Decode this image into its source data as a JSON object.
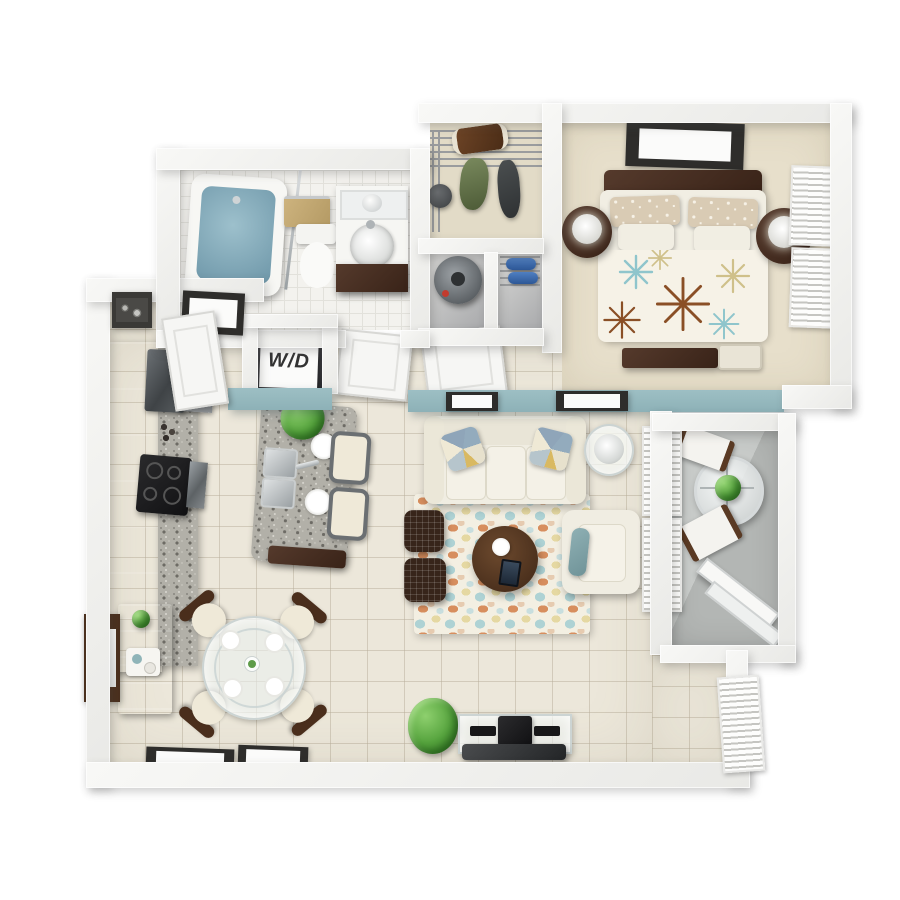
{
  "scene": {
    "description": "Top-down 3D render floor plan of a one-bedroom, one-bathroom apartment with balcony",
    "visible_text": [
      "W/D"
    ]
  },
  "labels": {
    "washer_dryer": "W/D"
  },
  "palette": {
    "background": "#ffffff",
    "wall": "#f1f1ef",
    "accent_wall_teal": "#9dbfc4",
    "tile_floor": "#ece7da",
    "bath_tile": "#f3f2ee",
    "carpet": "#e7dfcb",
    "balcony_concrete": "#b9bcba",
    "cabinet_espresso": "#46302a",
    "granite": "#b2b0a8",
    "appliance_black": "#1d1d1f",
    "stainless": "#9ea3a7",
    "sofa_cream": "#f1eee3",
    "rug_base": "#f3efe2",
    "rug_orange": "#d78e5e",
    "rug_teal": "#aed2d4",
    "rug_yellow": "#e5d8a2",
    "wood_dark": "#53382a",
    "ottoman_dark": "#37251a",
    "water_blue": "#7fa8b8",
    "plant_green": "#54a23c"
  },
  "rooms": {
    "bedroom": {
      "name": "Bedroom",
      "furniture": {
        "bed": "Queen bed with floral duvet",
        "headboard": "Dark wood headboard",
        "nightstand_left": "Round nightstand with lamp",
        "nightstand_right": "Round nightstand with lamp",
        "wall_art": "Framed wall art",
        "dresser": "Low dresser",
        "bench": "Bedside bench",
        "windows": "Windows with blinds"
      }
    },
    "closet": {
      "name": "Walk-in closet",
      "furniture": {
        "shelving": "Wire shelving",
        "clothes": "Hanging clothes",
        "duffel": "Duffel bag",
        "hat": "Hat"
      }
    },
    "utility": {
      "name": "Utility closets",
      "furniture": {
        "water_heater": "Water heater",
        "shoe_shelf": "Wire shoe shelf with shoes"
      }
    },
    "bathroom": {
      "name": "Bathroom",
      "furniture": {
        "tub": "Bathtub",
        "toilet": "Toilet",
        "vanity": "Vanity with vessel sink",
        "mirror": "Vanity mirror",
        "towel_bar": "Towel bar with towel",
        "rod": "Shower rod"
      }
    },
    "laundry": {
      "name": "Laundry closet",
      "unit": "Stacked washer/dryer"
    },
    "hallway": {
      "name": "Hallway",
      "doors": "Interior doors"
    },
    "entry": {
      "name": "Entry",
      "door": "Entry door",
      "picture": "Framed photo",
      "niche_art": "Wall niche decor"
    },
    "kitchen": {
      "name": "Kitchen",
      "furniture": {
        "cabinets": "Espresso cabinet run",
        "counter": "Granite counter",
        "fridge": "Refrigerator",
        "upper_cabinets": "Upper cabinets and hood",
        "cooktop": "Black cooktop",
        "oven": "Wall oven",
        "island": "Granite island",
        "sink": "Double stainless sink",
        "stool1": "Bar stool",
        "stool2": "Bar stool",
        "plant": "Potted herb",
        "plates": "Place setting",
        "decor": "Counter decor"
      }
    },
    "living": {
      "name": "Living room",
      "furniture": {
        "sofa": "Cream three-seat sofa",
        "pillow_left": "Patterned accent pillow",
        "pillow_right": "Patterned accent pillow",
        "side_table": "Glass side table with lamp",
        "rug": "Floral pebble area rug",
        "coffee_table": "Round dark wood coffee table",
        "ottoman1": "Woven ottoman",
        "ottoman2": "Woven ottoman",
        "armchair": "Armchair with teal pillow",
        "tv_console": "Glass media console with TV",
        "plant": "Potted plant",
        "art1": "Framed print",
        "art2": "Framed print",
        "accent_wall": "Teal accent wall",
        "windows": "Windows with blinds"
      }
    },
    "dining": {
      "name": "Dining area",
      "furniture": {
        "table": "Round glass dining table",
        "chair": "Dining chair",
        "sideboard": "Dark wood sideboard",
        "mirror": "Wall mirror",
        "frame1": "Framed print",
        "frame2": "Framed print"
      }
    },
    "balcony": {
      "name": "Balcony",
      "furniture": {
        "patio_table": "Round patio table with plant",
        "chair1": "Folding patio chair",
        "chair2": "Folding patio chair",
        "sliding_door": "Sliding glass door",
        "window": "Window with blinds"
      }
    }
  }
}
